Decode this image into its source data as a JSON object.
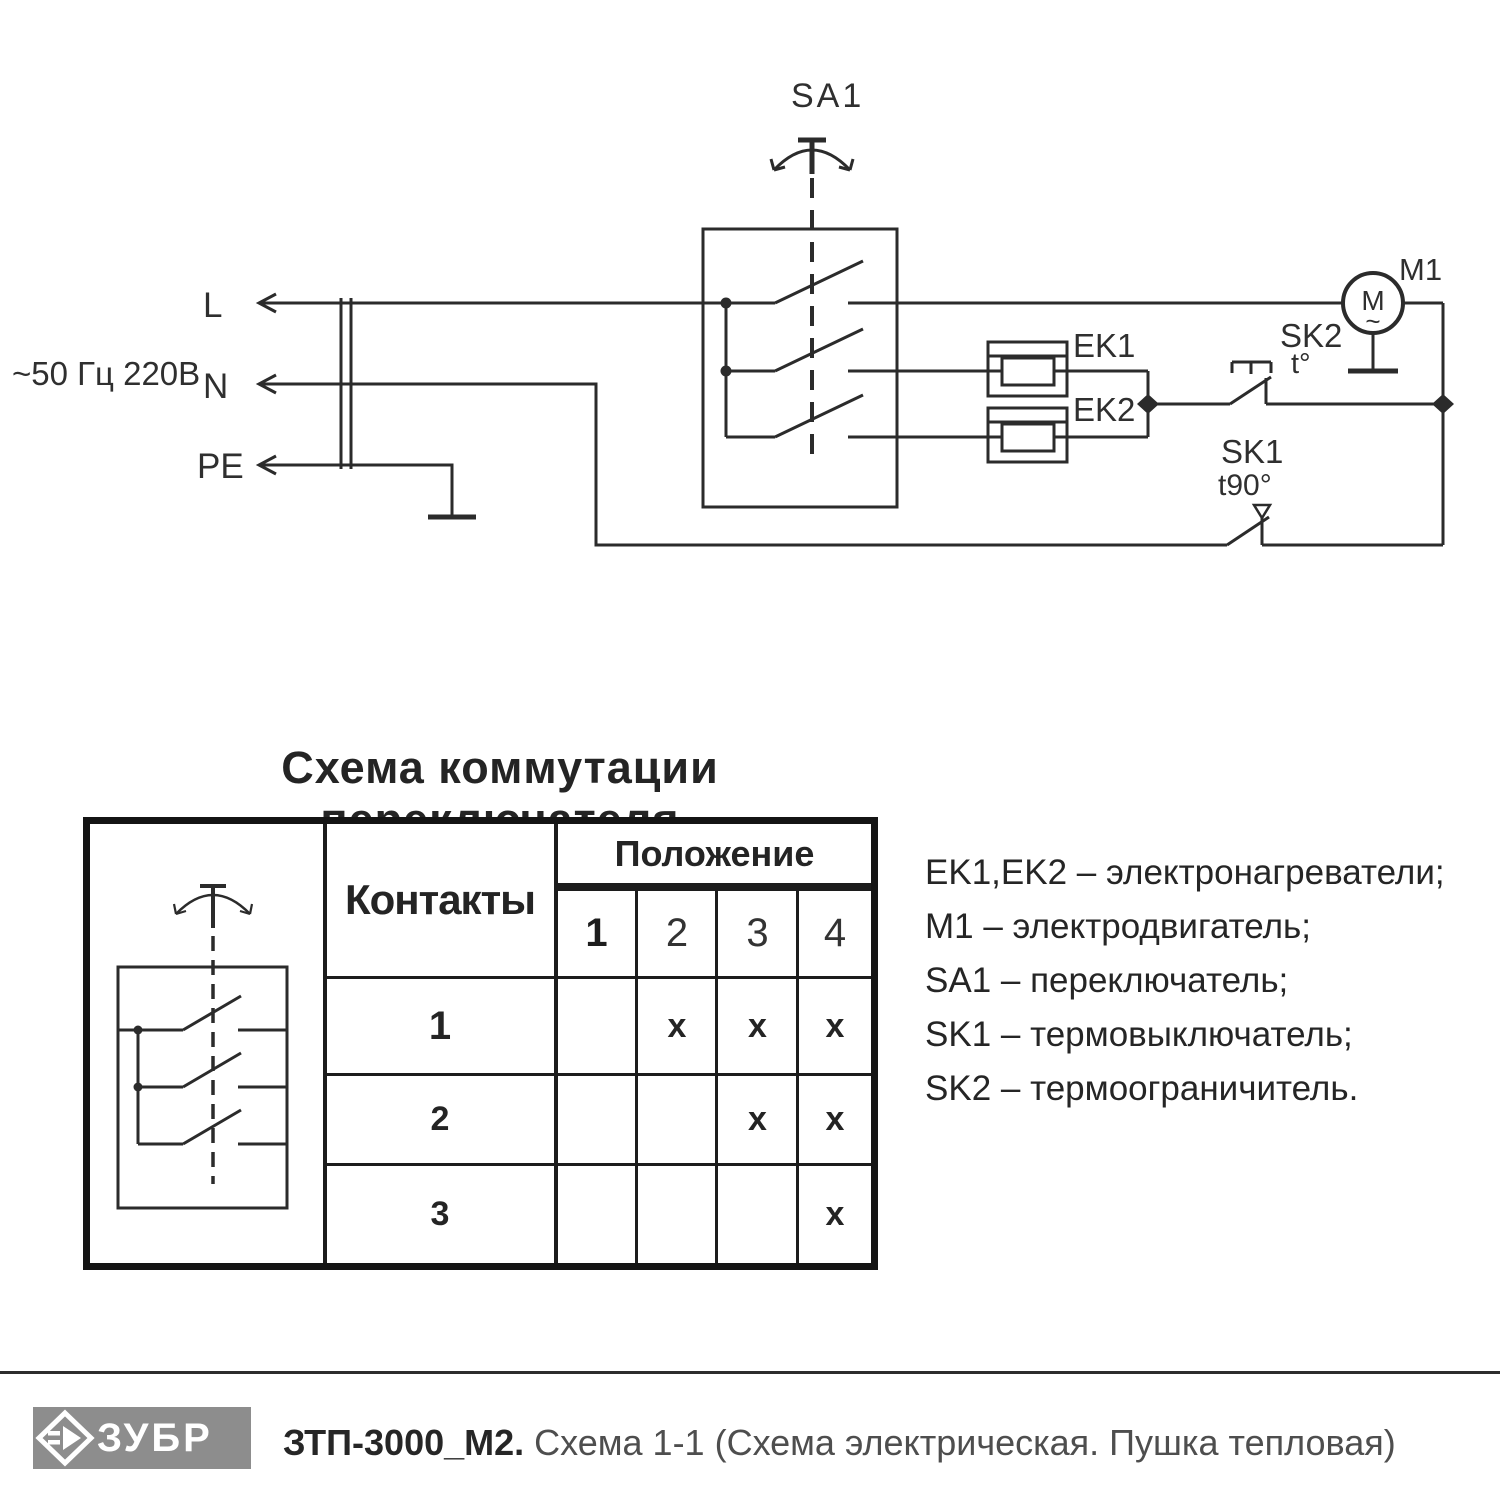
{
  "circuit": {
    "supply": "~50 Гц 220В",
    "terminal_l": "L",
    "terminal_n": "N",
    "terminal_pe": "PE",
    "sa1": "SA1",
    "ek1": "EK1",
    "ek2": "EK2",
    "m1": "M1",
    "motor_letter": "M",
    "motor_tilde": "~",
    "sk2": "SK2",
    "sk2_temp": "t°",
    "sk1": "SK1",
    "sk1_temp": "t90°"
  },
  "table": {
    "title": "Схема коммутации переключателя",
    "contacts_header": "Контакты",
    "position_header": "Положение",
    "positions": [
      "1",
      "2",
      "3",
      "4"
    ],
    "rows": [
      {
        "label": "1",
        "marks": [
          "",
          "x",
          "x",
          "x"
        ]
      },
      {
        "label": "2",
        "marks": [
          "",
          "",
          "x",
          "x"
        ]
      },
      {
        "label": "3",
        "marks": [
          "",
          "",
          "",
          "x"
        ]
      }
    ]
  },
  "legend": {
    "items": [
      "EK1,EK2 –  электронагреватели;",
      "M1 –  электродвигатель;",
      "SA1 –  переключатель;",
      "SK1 –  термовыключатель;",
      "SK2 –  термоограничитель."
    ]
  },
  "footer": {
    "brand": "ЗУБР",
    "model": "ЗТП-3000_М2.",
    "subtitle": "Схема 1-1 (Схема электрическая. Пушка тепловая)",
    "logo_bg": "#8d8d8d",
    "ink": "#2b2b2b"
  }
}
